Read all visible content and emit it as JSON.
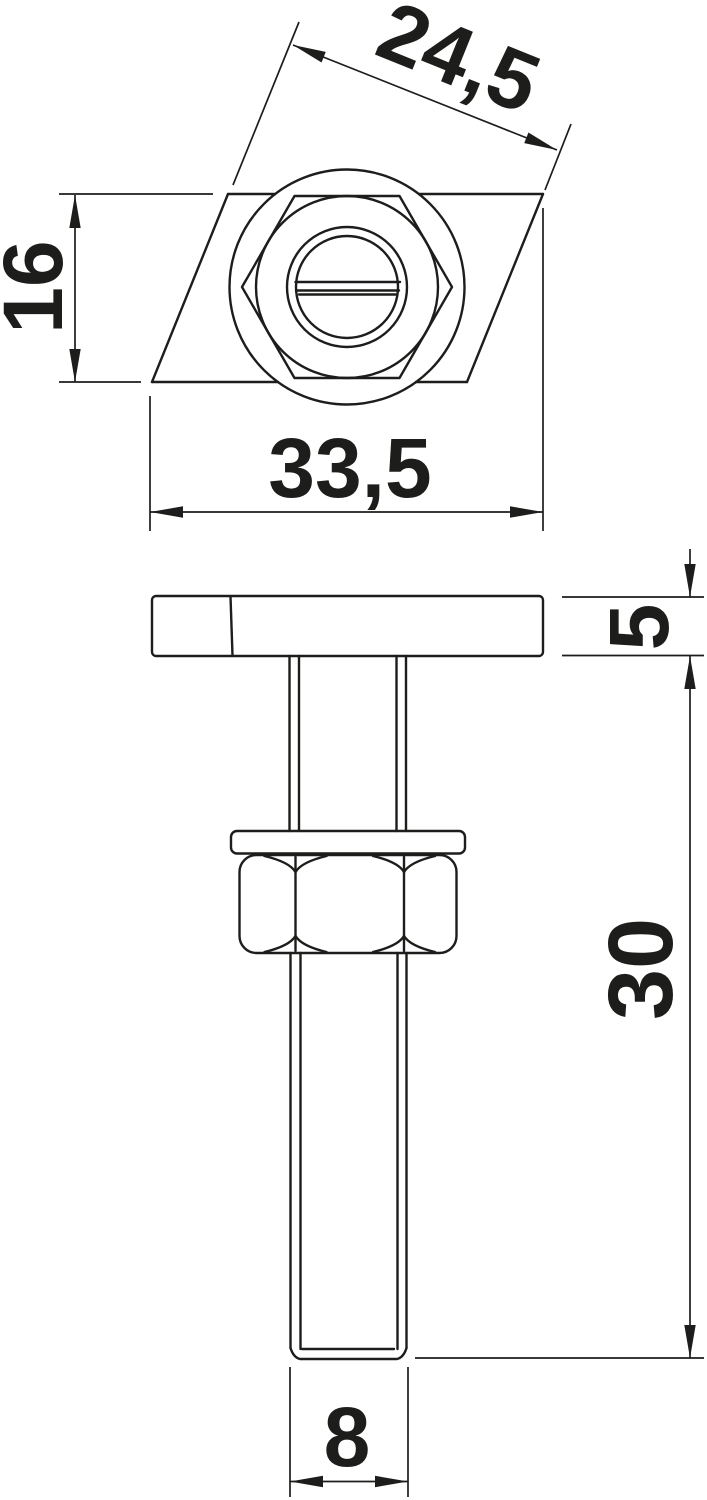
{
  "drawing": {
    "background": "#ffffff",
    "line_color": "#1d1d1b",
    "top_view": {
      "dim_head_diagonal": "24,5",
      "dim_head_height": "16",
      "dim_head_length": "33,5"
    },
    "side_view": {
      "dim_head_thickness": "5",
      "dim_shaft_length": "30",
      "dim_thread_diameter": "8"
    }
  }
}
